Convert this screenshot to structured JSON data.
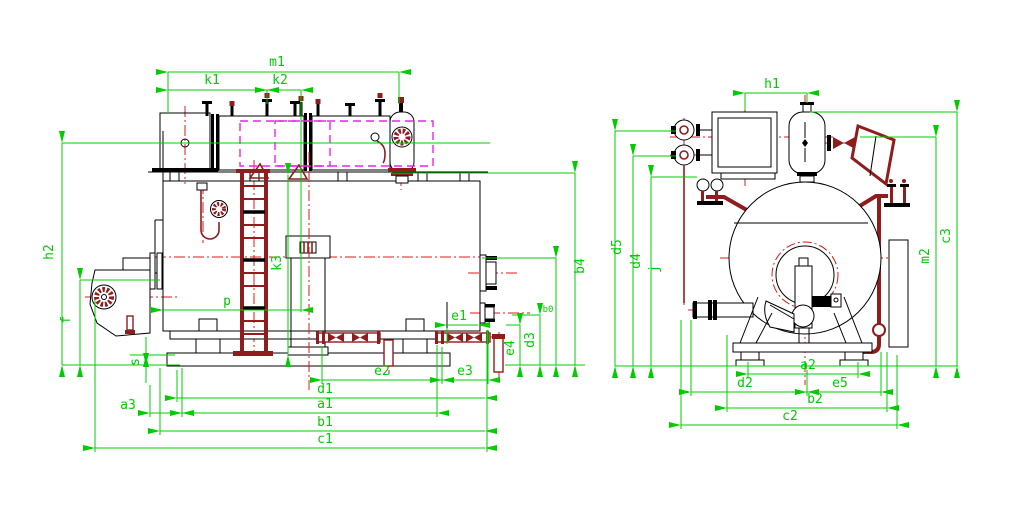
{
  "drawing": {
    "type": "boiler general-arrangement engineering drawing, two orthographic views",
    "colors": {
      "dimension_lines": "#00cc00",
      "outlines": "#000000",
      "details": "#8f1d1d",
      "centerlines": "#e01818",
      "phantom_lines": "#ee22ee",
      "background": "#ffffff"
    },
    "side_view": {
      "name": "side elevation",
      "dim_labels": {
        "m1": "m1",
        "k1": "k1",
        "k2": "k2",
        "h2": "h2",
        "f": "f",
        "s": "s",
        "a3": "a3",
        "p": "p",
        "k3": "k3",
        "e1": "e1",
        "e2": "e2",
        "e3": "e3",
        "e4": "e4",
        "d3": "d3",
        "b0": "b0",
        "b4": "b4",
        "d1": "d1",
        "a1": "a1",
        "b1": "b1",
        "c1": "c1"
      }
    },
    "end_view": {
      "name": "end elevation",
      "dim_labels": {
        "h1": "h1",
        "d5": "d5",
        "d4": "d4",
        "j": "j",
        "m2": "m2",
        "c3": "c3",
        "a2": "a2",
        "d2": "d2",
        "e5": "e5",
        "b2": "b2",
        "c2": "c2"
      }
    }
  }
}
